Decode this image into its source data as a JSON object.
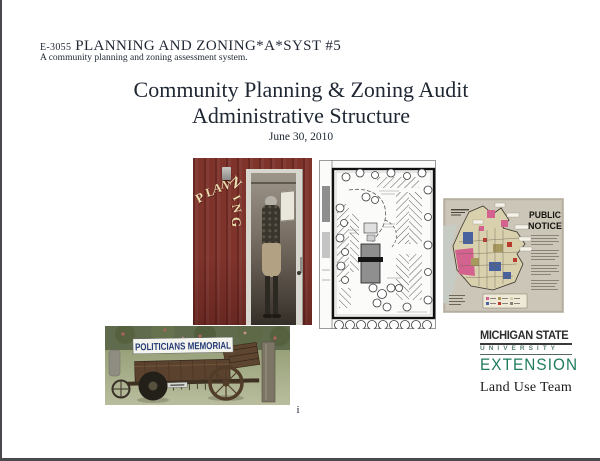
{
  "document": {
    "series_code": "E-3055",
    "series_title": "PLANNING AND ZONING*A*SYST #5",
    "series_subtitle": "A community planning and zoning assessment system.",
    "title_line1": "Community Planning & Zoning Audit",
    "title_line2": "Administrative Structure",
    "date": "June 30, 2010",
    "page_number": "i"
  },
  "photos": {
    "planning_door": {
      "painted_word": "PLANNING",
      "letters": [
        "P",
        "L",
        "A",
        "N",
        "N",
        "I",
        "N",
        "G"
      ],
      "wall_color": "#7E332B",
      "letter_color": "#E9DCAE"
    },
    "zoning_map": {
      "heading_line1": "PUBLIC",
      "heading_line2": "NOTICE",
      "zone_colors": [
        "#D4628F",
        "#47629E",
        "#BB3A2E",
        "#A89A5E",
        "#D9D0AE"
      ]
    },
    "wagon": {
      "sign_text": "POLITICIANS MEMORIAL",
      "sign_text_color": "#253A75"
    }
  },
  "logo": {
    "line1": "MICHIGAN STATE",
    "line2": "U N I V E R S I T Y",
    "line3": "EXTENSION",
    "team": "Land Use Team",
    "green": "#1F7B5C"
  }
}
